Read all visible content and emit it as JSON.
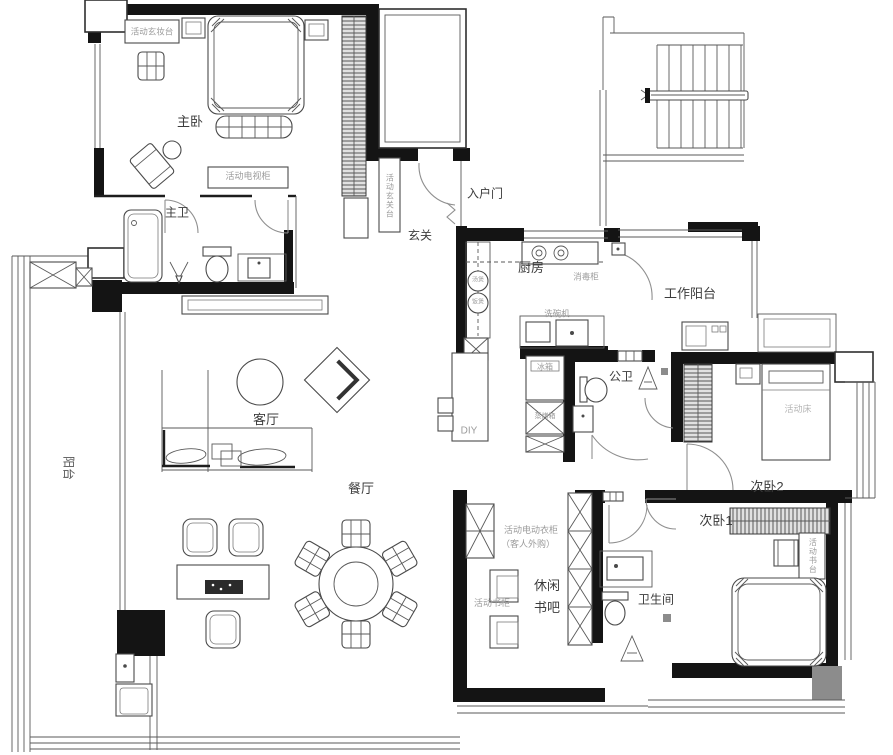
{
  "figure": "apartment-floor-plan",
  "colors": {
    "wall": "#141414",
    "line": "#4a4a4a",
    "gray_label": "#9b9b9b",
    "room_label": "#3c3c3c",
    "gray_block": "#8c8c8c"
  },
  "labels": {
    "master_bedroom": "主卧",
    "master_bath": "主卫",
    "dresser": "活动玄妆台",
    "tv_cabinet": "活动电视柜",
    "entry_console": "活动玄关台",
    "entry_door": "入户门",
    "foyer": "玄关",
    "kitchen": "厨房",
    "sterilizer": "消毒柜",
    "work_balcony": "工作阳台",
    "dishwasher": "洗碗机",
    "soup_pot": "汤煲",
    "rice_cooker": "饭煲",
    "fridge": "冰箱",
    "steam_oven": "蒸烤箱",
    "guest_bath": "公卫",
    "diy": "DIY",
    "balcony": "阳台",
    "living_room": "客厅",
    "dining_room": "餐厅",
    "movable_bed": "活动床",
    "bedroom2": "次卧2",
    "bedroom1": "次卧1",
    "desk": "活动书台",
    "wardrobe_note_line1": "活动电动衣柜",
    "wardrobe_note_line2": "（客人外购）",
    "book_bar_line1": "休闲",
    "book_bar_line2": "书吧",
    "bookcase": "活动书柜",
    "bathroom": "卫生间"
  }
}
